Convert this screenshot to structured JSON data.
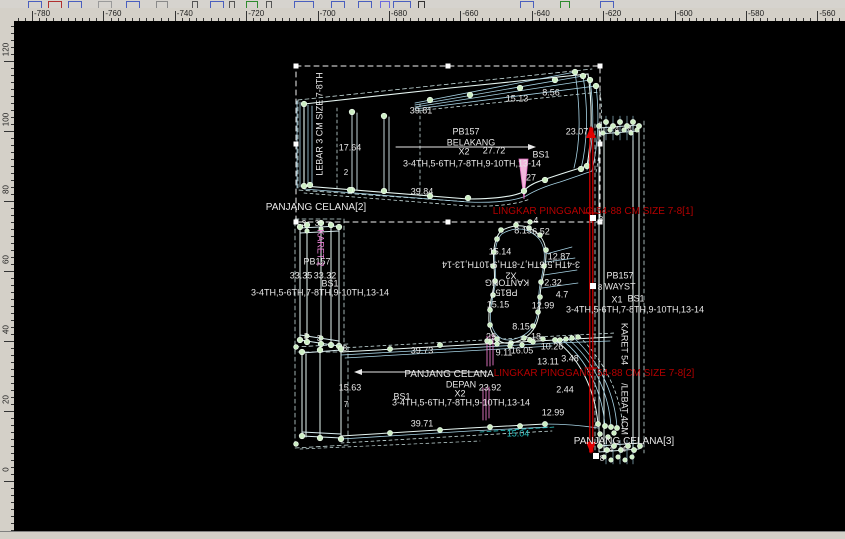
{
  "toolbar": {
    "background": "#d6d3ce",
    "fragments": [
      {
        "x": 28,
        "c": "#4a5fbf",
        "w": 12
      },
      {
        "x": 48,
        "c": "#b03030",
        "w": 12
      },
      {
        "x": 68,
        "c": "#4a5fbf",
        "w": 12
      },
      {
        "x": 98,
        "c": "#9a9a9a",
        "w": 12
      },
      {
        "x": 126,
        "c": "#4a5fbf",
        "w": 12
      },
      {
        "x": 156,
        "c": "#8a8a8a",
        "w": 10
      },
      {
        "x": 192,
        "c": "#555555",
        "w": 4
      },
      {
        "x": 210,
        "c": "#4a5fbf",
        "w": 12
      },
      {
        "x": 229,
        "c": "#555555",
        "w": 4
      },
      {
        "x": 246,
        "c": "#2e8b2e",
        "w": 10
      },
      {
        "x": 266,
        "c": "#555555",
        "w": 4
      },
      {
        "x": 294,
        "c": "#4a5fbf",
        "w": 18
      },
      {
        "x": 331,
        "c": "#4a5fbf",
        "w": 12
      },
      {
        "x": 358,
        "c": "#4a5fbf",
        "w": 12
      },
      {
        "x": 380,
        "c": "#6a6adf",
        "w": 8
      },
      {
        "x": 393,
        "c": "#4a5fbf",
        "w": 16
      },
      {
        "x": 418,
        "c": "#333333",
        "w": 5
      },
      {
        "x": 520,
        "c": "#4a5fbf",
        "w": 12
      },
      {
        "x": 560,
        "c": "#2e8b2e",
        "w": 8
      },
      {
        "x": 600,
        "c": "#4a5fbf",
        "w": 12
      }
    ]
  },
  "rulers": {
    "background": "#d4d0c8",
    "top": {
      "labels": [
        "-780",
        "-760",
        "-740",
        "-720",
        "-700",
        "-680",
        "-660",
        "-640",
        "-620",
        "-600",
        "-580",
        "-560"
      ],
      "origin": 32,
      "step": 71.4,
      "minor": 7.14
    },
    "left": {
      "labels": [
        "120",
        "100",
        "80",
        "60",
        "40",
        "20",
        "0"
      ],
      "origin": 61,
      "step": 70,
      "minor": 7
    }
  },
  "canvas": {
    "colors": {
      "white": "#e8e8e8",
      "red": "#b40000",
      "teal": "#2ec4c4",
      "pink": "#ee82d8"
    },
    "labels": [
      {
        "text": "39.81",
        "x": 421,
        "y": 111
      },
      {
        "text": "15.13",
        "x": 517,
        "y": 99
      },
      {
        "text": "8.56",
        "x": 551,
        "y": 93
      },
      {
        "text": "23.07",
        "x": 577,
        "y": 132
      },
      {
        "text": "PB157",
        "x": 466,
        "y": 132
      },
      {
        "text": "BELAKANG",
        "x": 471,
        "y": 143,
        "name": "piece-label"
      },
      {
        "text": "X2",
        "x": 464,
        "y": 152
      },
      {
        "text": "27.72",
        "x": 494,
        "y": 151
      },
      {
        "text": "BS1",
        "x": 541,
        "y": 155
      },
      {
        "text": "3-4TH,5-6TH,7-8TH,9-10TH,13-14",
        "x": 472,
        "y": 164,
        "name": "size-list-label"
      },
      {
        "text": "17.64",
        "x": 350,
        "y": 148
      },
      {
        "text": "2",
        "x": 346,
        "y": 173,
        "s": 8,
        "name": "node-label"
      },
      {
        "text": "27",
        "x": 531,
        "y": 178
      },
      {
        "text": "39.84",
        "x": 422,
        "y": 192
      },
      {
        "text": "PANJANG CELANA[2]",
        "x": 316,
        "y": 208,
        "s": 10,
        "name": "piece-label"
      },
      {
        "text": "LEBAR 3 CM SIZE 7-8TH",
        "x": 320,
        "y": 124,
        "rot": -90,
        "name": "piece-label"
      },
      {
        "text": "PB157",
        "x": 317,
        "y": 262
      },
      {
        "text": "33.35",
        "x": 301,
        "y": 276
      },
      {
        "text": "33.32",
        "x": 325,
        "y": 276
      },
      {
        "text": "BS1",
        "x": 330,
        "y": 284
      },
      {
        "text": "3-4TH,5-6TH,7-8TH,9-10TH,13-14",
        "x": 320,
        "y": 293,
        "name": "size-list-label"
      },
      {
        "text": "KARET 2",
        "x": 320,
        "y": 248,
        "rot": 90,
        "c": "pink"
      },
      {
        "text": "8.15",
        "x": 523,
        "y": 231
      },
      {
        "text": "6.52",
        "x": 541,
        "y": 232
      },
      {
        "text": "15.14",
        "x": 500,
        "y": 252
      },
      {
        "text": "12.87",
        "x": 559,
        "y": 257
      },
      {
        "text": "3-4TH,5-6TH,7-8TH,9-10TH,13-14",
        "x": 511,
        "y": 264,
        "rot": 180,
        "name": "size-list-label"
      },
      {
        "text": "X2",
        "x": 511,
        "y": 275,
        "rot": 180
      },
      {
        "text": "KANTONG",
        "x": 507,
        "y": 282,
        "rot": 180,
        "name": "piece-label"
      },
      {
        "text": "PB157",
        "x": 504,
        "y": 292,
        "rot": 180
      },
      {
        "text": "2.32",
        "x": 553,
        "y": 283
      },
      {
        "text": "4.7",
        "x": 562,
        "y": 295
      },
      {
        "text": "15.15",
        "x": 498,
        "y": 305
      },
      {
        "text": "12.99",
        "x": 543,
        "y": 306
      },
      {
        "text": "8.15",
        "x": 521,
        "y": 327
      },
      {
        "text": "29",
        "x": 491,
        "y": 337
      },
      {
        "text": "18",
        "x": 536,
        "y": 337
      },
      {
        "text": "9.11",
        "x": 504,
        "y": 353
      },
      {
        "text": "16.05",
        "x": 522,
        "y": 351
      },
      {
        "text": "10.26",
        "x": 552,
        "y": 347
      },
      {
        "text": "13.11",
        "x": 548,
        "y": 362
      },
      {
        "text": "3.48",
        "x": 570,
        "y": 359
      },
      {
        "text": "39.73",
        "x": 422,
        "y": 351
      },
      {
        "text": "8",
        "x": 345,
        "y": 349,
        "s": 8,
        "name": "node-label"
      },
      {
        "text": "PANJANG CELANA",
        "x": 449,
        "y": 375,
        "s": 10,
        "name": "piece-label"
      },
      {
        "text": "DEPAN",
        "x": 461,
        "y": 385,
        "name": "piece-label"
      },
      {
        "text": "23.92",
        "x": 490,
        "y": 388
      },
      {
        "text": "X2",
        "x": 460,
        "y": 394
      },
      {
        "text": "BS1",
        "x": 402,
        "y": 397
      },
      {
        "text": "3-4TH,5-6TH,7-8TH,9-10TH,13-14",
        "x": 461,
        "y": 403,
        "name": "size-list-label"
      },
      {
        "text": "15.63",
        "x": 350,
        "y": 388
      },
      {
        "text": "7",
        "x": 346,
        "y": 405,
        "s": 8,
        "name": "node-label"
      },
      {
        "text": "39.71",
        "x": 422,
        "y": 424
      },
      {
        "text": "15.04",
        "x": 518,
        "y": 434,
        "c": "teal"
      },
      {
        "text": "12.99",
        "x": 553,
        "y": 413
      },
      {
        "text": "2.44",
        "x": 565,
        "y": 390
      },
      {
        "text": "PB157",
        "x": 620,
        "y": 276
      },
      {
        "text": "WAYST",
        "x": 620,
        "y": 287,
        "name": "piece-label"
      },
      {
        "text": "X1",
        "x": 617,
        "y": 300
      },
      {
        "text": "BS1",
        "x": 636,
        "y": 299
      },
      {
        "text": "3-4TH,5-6TH,7-8TH,9-10TH,13-14",
        "x": 635,
        "y": 310,
        "name": "size-list-label"
      },
      {
        "text": "KARET 54",
        "x": 624,
        "y": 344,
        "rot": 90
      },
      {
        "text": "/LEBAT 4CM",
        "x": 624,
        "y": 409,
        "rot": 90
      },
      {
        "text": "PANJANG CELANA[3]",
        "x": 624,
        "y": 442,
        "s": 10,
        "name": "piece-label"
      },
      {
        "text": "4",
        "x": 617,
        "y": 130,
        "s": 8,
        "name": "node-label"
      },
      {
        "text": "4",
        "x": 630,
        "y": 130,
        "s": 8,
        "name": "node-label"
      },
      {
        "text": "4",
        "x": 611,
        "y": 450,
        "s": 8,
        "name": "node-label"
      },
      {
        "text": "4",
        "x": 624,
        "y": 450,
        "s": 8,
        "name": "node-label"
      },
      {
        "text": "8",
        "x": 601,
        "y": 220,
        "s": 8,
        "name": "node-label"
      },
      {
        "text": "8",
        "x": 600,
        "y": 288,
        "s": 8,
        "name": "node-label"
      },
      {
        "text": "8",
        "x": 602,
        "y": 459,
        "s": 8,
        "name": "node-label"
      },
      {
        "text": "3",
        "x": 304,
        "y": 224,
        "s": 8,
        "name": "node-label"
      },
      {
        "text": "3",
        "x": 317,
        "y": 224,
        "s": 8,
        "name": "node-label"
      },
      {
        "text": "3",
        "x": 306,
        "y": 337,
        "s": 8,
        "name": "node-label"
      },
      {
        "text": "3",
        "x": 319,
        "y": 339,
        "s": 8,
        "name": "node-label"
      },
      {
        "text": "4",
        "x": 536,
        "y": 221,
        "s": 8,
        "name": "node-label"
      },
      {
        "text": "LINGKAR PINGGANG 54-88 CM SIZE 7-8[1]",
        "x": 593,
        "y": 212,
        "c": "red",
        "s": 10,
        "name": "dimension-label"
      },
      {
        "text": "LINGKAR PINGGANG 54-88 CM SIZE 7-8[2]",
        "x": 594,
        "y": 374,
        "c": "red",
        "s": 10,
        "name": "dimension-label"
      }
    ]
  }
}
